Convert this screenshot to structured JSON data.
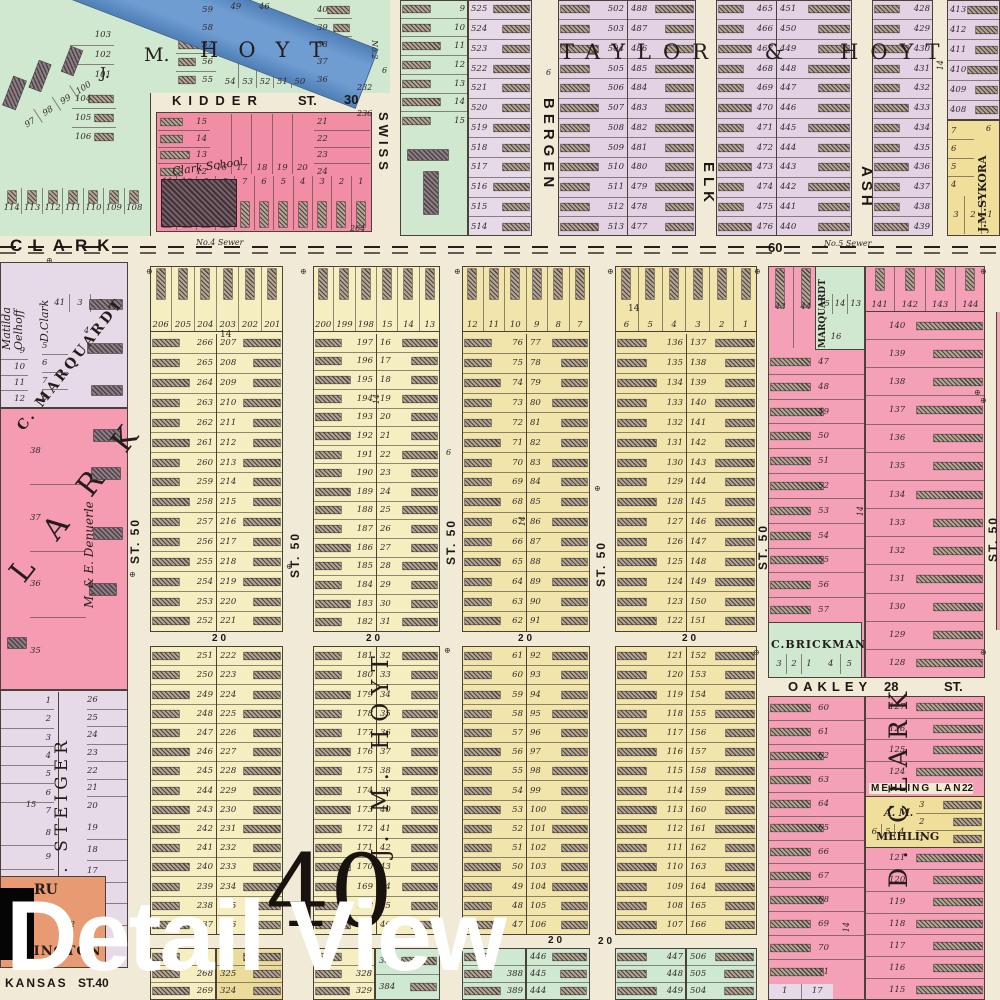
{
  "overlay": {
    "title": "Detail View"
  },
  "plate": {
    "number": "40"
  },
  "symbols": {
    "benchmark": "⊕"
  },
  "streets": {
    "clark": "CLARK",
    "kidder": "KIDDER",
    "st": "ST.",
    "kidder_no": "30",
    "swiss": "SWISS",
    "bergen": "BERGEN",
    "elk": "ELK",
    "ash": "ASH",
    "oakley": "OAKLEY",
    "oakley_no": "28",
    "mehling_lane": "MEHLING LANE",
    "mehling_no": "22",
    "kansas": "KANSAS",
    "kansas_st": "ST.40",
    "st50": "ST. 50",
    "fifty": "50",
    "sixty": "60",
    "twenty": "20",
    "fourteen": "14",
    "six": "6",
    "no2": "No.2",
    "sewer4": "No.4 Sewer",
    "sewer5": "No.5 Sewer",
    "n232": "232",
    "n236": "236",
    "n264": "264",
    "n15": "15",
    "n4": "4",
    "n2": "2"
  },
  "owners": {
    "j": "J.",
    "m": "M.",
    "hoyt": "HOYT",
    "taylor_hoyt": "TAYLOR & HOYT",
    "clark_school": "Clark School",
    "matilda1": "Matilda",
    "matilda2": "Oelhoff",
    "dclark": "D.Clark",
    "marquardt": "C. MARQUARDT",
    "clark_big": "C L A R K",
    "denuerle": "M. & E. Denuerle",
    "steiger": "J. G. STEIGER",
    "sykora": "J.M.SYKORA",
    "marquardt2": "MARQUARDT",
    "brickman": "C.BRICKMAN",
    "mehling1": "A. M.",
    "mehling2": "MEHLING",
    "dclark_big": "D. CLARK",
    "jmhoyt_v": "J. M. HOYT",
    "ru": "RU",
    "aslington": "ASLINGTON"
  },
  "cols": {
    "tl_top": [
      "49",
      "46"
    ],
    "tl_a": [
      "59",
      "58",
      "57",
      "56",
      "55"
    ],
    "tl_row": [
      "54",
      "53",
      "52",
      "51",
      "50"
    ],
    "tl_b": [
      "40",
      "39",
      "38",
      "37",
      "36"
    ],
    "tl_c": [
      "103",
      "102",
      "101"
    ],
    "tl_d": [
      "104",
      "105",
      "106"
    ],
    "tl_diag": [
      "97",
      "98",
      "99",
      "100"
    ],
    "tl_bottom": [
      "114",
      "113",
      "112",
      "111",
      "110",
      "109",
      "108"
    ],
    "kidder_left": [
      "15",
      "14",
      "13",
      "12"
    ],
    "kidder_mid": [
      "16",
      "17",
      "18",
      "19",
      "20"
    ],
    "kidder_right": [
      "21",
      "22",
      "23",
      "24"
    ],
    "kidder_bottom": [
      "11",
      "10",
      "9",
      "8",
      "7",
      "6",
      "5",
      "4",
      "3",
      "2",
      "1"
    ],
    "green2": [
      "9",
      "10",
      "11",
      "12",
      "13",
      "14",
      "15"
    ],
    "lav1": [
      "525",
      "524",
      "523",
      "522",
      "521",
      "520",
      "519",
      "518",
      "517",
      "516",
      "515",
      "514"
    ],
    "taylor_a": [
      "502",
      "503",
      "504",
      "505",
      "506",
      "507",
      "508",
      "509",
      "510",
      "511",
      "512",
      "513"
    ],
    "taylor_b": [
      "488",
      "487",
      "486",
      "485",
      "484",
      "483",
      "482",
      "481",
      "480",
      "479",
      "478",
      "477"
    ],
    "hoyt_a": [
      "465",
      "466",
      "467",
      "468",
      "469",
      "470",
      "471",
      "472",
      "473",
      "474",
      "475",
      "476"
    ],
    "hoyt_b": [
      "451",
      "450",
      "449",
      "448",
      "447",
      "446",
      "445",
      "444",
      "443",
      "442",
      "441",
      "440"
    ],
    "hoyt_c": [
      "428",
      "429",
      "430",
      "431",
      "432",
      "433",
      "434",
      "435",
      "436",
      "437",
      "438",
      "439"
    ],
    "hoyt_d": [
      "413",
      "412",
      "411",
      "410",
      "409",
      "408"
    ],
    "sykora_col": [
      "7",
      "6",
      "5",
      "4"
    ],
    "sykora_row": [
      "3",
      "2",
      "1"
    ],
    "lt_row": [
      "41",
      "3",
      "2"
    ],
    "lt_a": [
      "9",
      "10",
      "11",
      "12"
    ],
    "lt_b": [
      "5",
      "6",
      "7",
      "8"
    ],
    "lark": [
      "38",
      "37",
      "36",
      "35"
    ],
    "steiger_a": [
      "1",
      "2",
      "3",
      "4",
      "5",
      "6",
      "7"
    ],
    "steiger_a2": [
      "8",
      "9",
      "10",
      "11"
    ],
    "steiger_b": [
      "26",
      "25",
      "24",
      "23",
      "22",
      "21",
      "20"
    ],
    "steiger_b2": [
      "19",
      "18",
      "17",
      "16",
      "15",
      "14"
    ],
    "s1_top": [
      "206",
      "205",
      "204",
      "203",
      "202",
      "201"
    ],
    "s1a": [
      "266",
      "265",
      "264",
      "263",
      "262",
      "261",
      "260",
      "259",
      "258",
      "257",
      "256",
      "255",
      "254",
      "253",
      "252"
    ],
    "s1b": [
      "207",
      "208",
      "209",
      "210",
      "211",
      "212",
      "213",
      "214",
      "215",
      "216",
      "217",
      "218",
      "219",
      "220",
      "221"
    ],
    "s1a2": [
      "251",
      "250",
      "249",
      "248",
      "247",
      "246",
      "245",
      "244",
      "243",
      "242",
      "241",
      "240",
      "239",
      "238",
      "237"
    ],
    "s1b2": [
      "222",
      "223",
      "224",
      "225",
      "226",
      "227",
      "228",
      "229",
      "230",
      "231",
      "232",
      "233",
      "234",
      "235",
      "236"
    ],
    "s1g_a": [
      "",
      "268",
      "269"
    ],
    "s1g_b": [
      "",
      "325",
      "324"
    ],
    "s2_top": [
      "200",
      "199",
      "198",
      "15",
      "14",
      "13"
    ],
    "s2a": [
      "197",
      "196",
      "195",
      "194",
      "193",
      "192",
      "191",
      "190",
      "189",
      "188",
      "187",
      "186",
      "185",
      "184",
      "183",
      "182"
    ],
    "s2b": [
      "16",
      "17",
      "18",
      "19",
      "20",
      "21",
      "22",
      "23",
      "24",
      "25",
      "26",
      "27",
      "28",
      "29",
      "30",
      "31"
    ],
    "s2a2": [
      "181",
      "180",
      "179",
      "178",
      "177",
      "176",
      "175",
      "174",
      "173",
      "172",
      "171",
      "170",
      "169",
      "168",
      "167"
    ],
    "s2b2": [
      "32",
      "33",
      "34",
      "35",
      "36",
      "37",
      "38",
      "39",
      "40",
      "41",
      "42",
      "43",
      "44",
      "45",
      "46"
    ],
    "s2g_a": [
      "",
      "328",
      "329"
    ],
    "s2g_b": [
      "385",
      "384"
    ],
    "s3_top": [
      "12",
      "11",
      "10",
      "9",
      "8",
      "7"
    ],
    "s3a": [
      "76",
      "75",
      "74",
      "73",
      "72",
      "71",
      "70",
      "69",
      "68",
      "67",
      "66",
      "65",
      "64",
      "63",
      "62"
    ],
    "s3b": [
      "77",
      "78",
      "79",
      "80",
      "81",
      "82",
      "83",
      "84",
      "85",
      "86",
      "87",
      "88",
      "89",
      "90",
      "91"
    ],
    "s3a2": [
      "61",
      "60",
      "59",
      "58",
      "57",
      "56",
      "55",
      "54",
      "53",
      "52",
      "51",
      "50",
      "49",
      "48",
      "47"
    ],
    "s3b2": [
      "92",
      "93",
      "94",
      "95",
      "96",
      "97",
      "98",
      "99",
      "100",
      "101",
      "102",
      "103",
      "104",
      "105",
      "106"
    ],
    "s3g_a": [
      "",
      "388",
      "389"
    ],
    "s3g_b": [
      "446",
      "445",
      "444"
    ],
    "s4_top": [
      "6",
      "5",
      "4",
      "3",
      "2",
      "1"
    ],
    "s4a": [
      "136",
      "135",
      "134",
      "133",
      "132",
      "131",
      "130",
      "129",
      "128",
      "127",
      "126",
      "125",
      "124",
      "123",
      "122"
    ],
    "s4b": [
      "137",
      "138",
      "139",
      "140",
      "141",
      "142",
      "143",
      "144",
      "145",
      "146",
      "147",
      "148",
      "149",
      "150",
      "151"
    ],
    "s4a2": [
      "121",
      "120",
      "119",
      "118",
      "117",
      "116",
      "115",
      "114",
      "113",
      "112",
      "111",
      "110",
      "109",
      "108",
      "107"
    ],
    "s4b2": [
      "152",
      "153",
      "154",
      "155",
      "156",
      "157",
      "158",
      "159",
      "160",
      "161",
      "162",
      "163",
      "164",
      "165",
      "166"
    ],
    "s4g_a": [
      "447",
      "448",
      "449"
    ],
    "s4g_b": [
      "506",
      "505",
      "504"
    ],
    "s5_top": [
      "43",
      "44"
    ],
    "marq_row": [
      "15",
      "14",
      "13"
    ],
    "marq_b": [
      "16"
    ],
    "s5a": [
      "47",
      "48",
      "49",
      "50",
      "51",
      "52",
      "53",
      "54",
      "55",
      "56",
      "57"
    ],
    "brick_a": [
      "3",
      "2",
      "1"
    ],
    "brick_b": [
      "4",
      "5"
    ],
    "s5a2": [
      "60",
      "61",
      "62",
      "63",
      "64",
      "65",
      "66",
      "67",
      "68",
      "69",
      "70",
      "71"
    ],
    "s5_bot": [
      "1",
      "17"
    ],
    "s6_top": [
      "141",
      "142",
      "143",
      "144"
    ],
    "s6a": [
      "140",
      "139",
      "138",
      "137",
      "136",
      "135",
      "134",
      "133",
      "132",
      "131",
      "130",
      "129",
      "128"
    ],
    "s6b": [
      "127",
      "126",
      "125",
      "124"
    ],
    "mehl_l": [
      "6",
      "5",
      "4"
    ],
    "mehl_r": [
      "3",
      "2",
      "1"
    ],
    "s6a2": [
      "121",
      "120",
      "119",
      "118",
      "117",
      "116",
      "115"
    ]
  }
}
